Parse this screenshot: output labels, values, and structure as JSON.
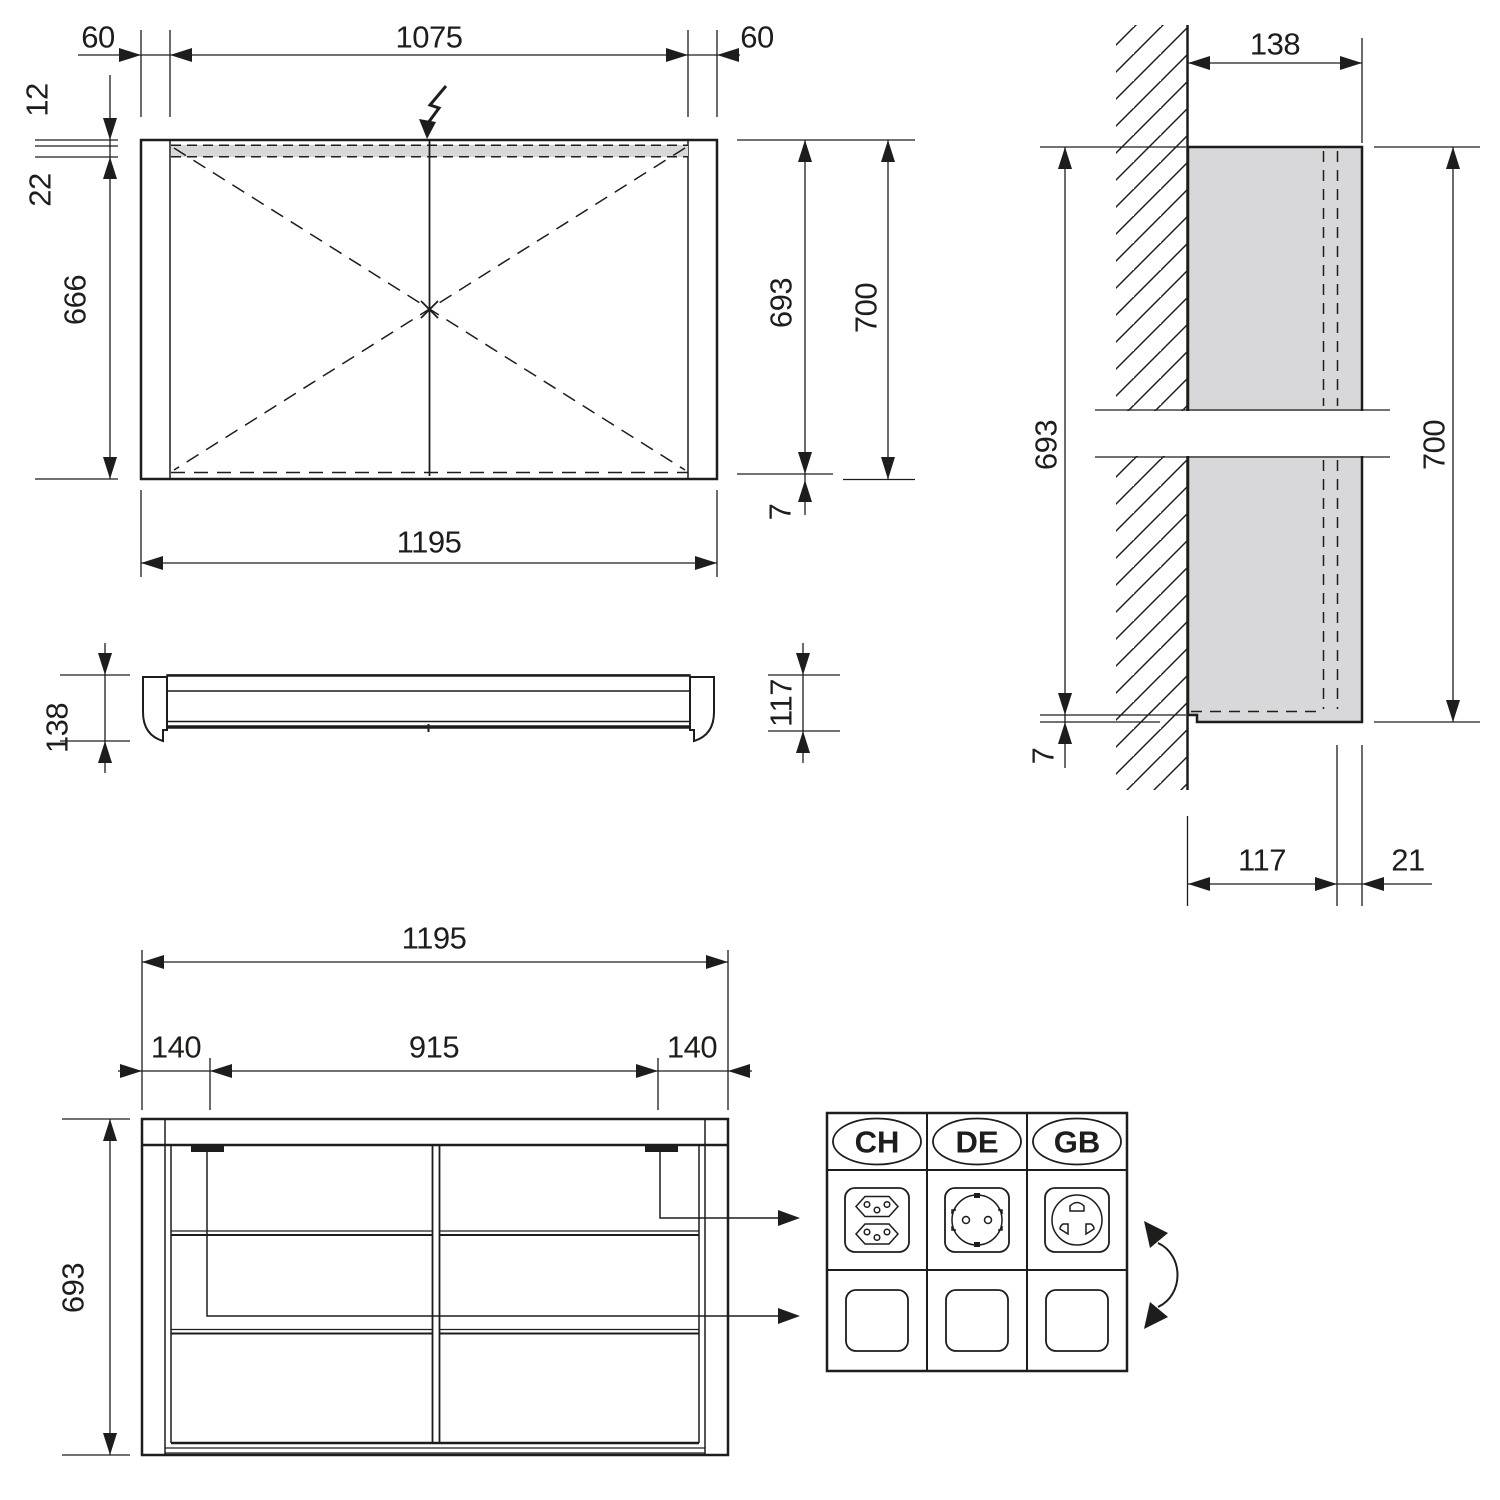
{
  "colors": {
    "line": "#1d1d1b",
    "light_gray_fill": "#d8d8da",
    "background": "#ffffff"
  },
  "icons": {
    "power_supply": "lightning-icon",
    "wall": "hatch-pattern",
    "leaders": "leader-arrow",
    "rotation": "swap-rotation-arrow-icon",
    "sockets": [
      "ch-socket-icon",
      "de-socket-icon",
      "gb-socket-icon",
      "blank-plate-icon"
    ]
  },
  "front_view": {
    "top_dims": {
      "left": "60",
      "center": "1075",
      "right": "60"
    },
    "left_dims": {
      "lamp_offset": "12",
      "lamp_height": "22",
      "inner_height": "666"
    },
    "right_dims": {
      "carcass_height": "693",
      "overall_height": "700",
      "bottom_gap": "7"
    },
    "bottom_dim": "1195"
  },
  "profile_view": {
    "overall_depth": "138",
    "body_depth": "117"
  },
  "side_view": {
    "top_depth": "138",
    "carcass_height": "693",
    "bottom_gap": "7",
    "overall_height": "700",
    "body_depth": "117",
    "door_thickness": "21"
  },
  "interior_view": {
    "overall_width": "1195",
    "offset_left": "140",
    "socket_span": "915",
    "offset_right": "140",
    "height": "693"
  },
  "socket_table": {
    "columns": [
      {
        "country": "CH",
        "socket_icon": "ch-socket-icon"
      },
      {
        "country": "DE",
        "socket_icon": "de-socket-icon"
      },
      {
        "country": "GB",
        "socket_icon": "gb-socket-icon"
      }
    ]
  }
}
